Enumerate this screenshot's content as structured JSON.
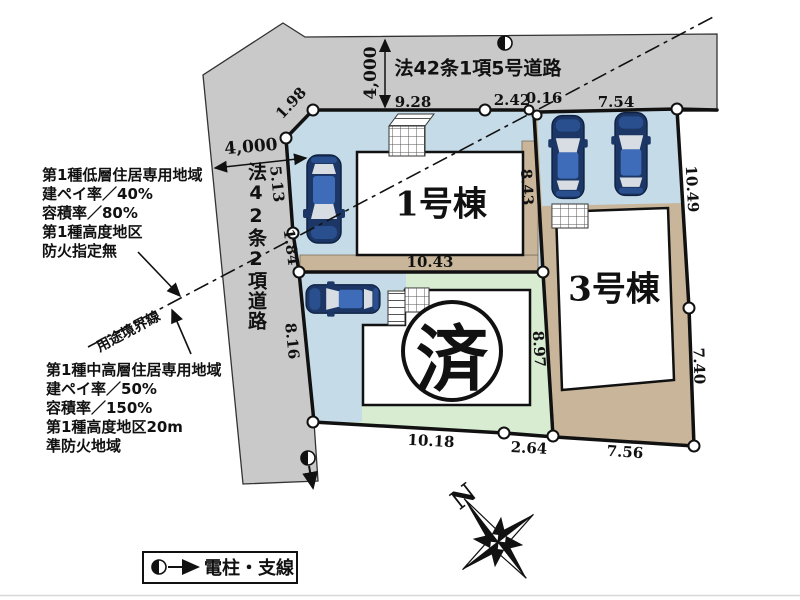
{
  "roads": {
    "top": {
      "name": "法42条1項5号道路",
      "width": "4,000"
    },
    "left": {
      "name": "法42条2項道路",
      "width": "4,000"
    }
  },
  "zoning": {
    "north": [
      "第1種低層住居専用地域",
      "建ペイ率／40%",
      "容積率／80%",
      "第1種高度地区",
      "防火指定無"
    ],
    "south": [
      "第1種中高層住居専用地域",
      "建ペイ率／50%",
      "容積率／150%",
      "第1種高度地区20m",
      "準防火地域"
    ],
    "boundary_label": "用途境界線"
  },
  "buildings": {
    "b1": "1号棟",
    "b2_sold_mark": "済",
    "b3": "3号棟"
  },
  "dimensions": {
    "top1": "9.28",
    "top2": "2.42",
    "top3": "0.16",
    "top4": "7.54",
    "left1": "1.98",
    "left2": "5.13",
    "left3": "1.84",
    "left4": "8.16",
    "inner1": "8.43",
    "inner2": "10.43",
    "inner3": "8.97",
    "right1": "10.49",
    "right2": "7.40",
    "bottom1": "10.18",
    "bottom2": "2.64",
    "bottom3": "7.56"
  },
  "legend": {
    "label": "電柱・支線"
  },
  "compass": {
    "north": "N"
  },
  "colors": {
    "road": "#c9c9c9",
    "parking": "#c5dbe8",
    "lot_green": "#d8ecd2",
    "ground_tan": "#c9b69a",
    "line": "#111111",
    "car_body": "#1c3765"
  }
}
